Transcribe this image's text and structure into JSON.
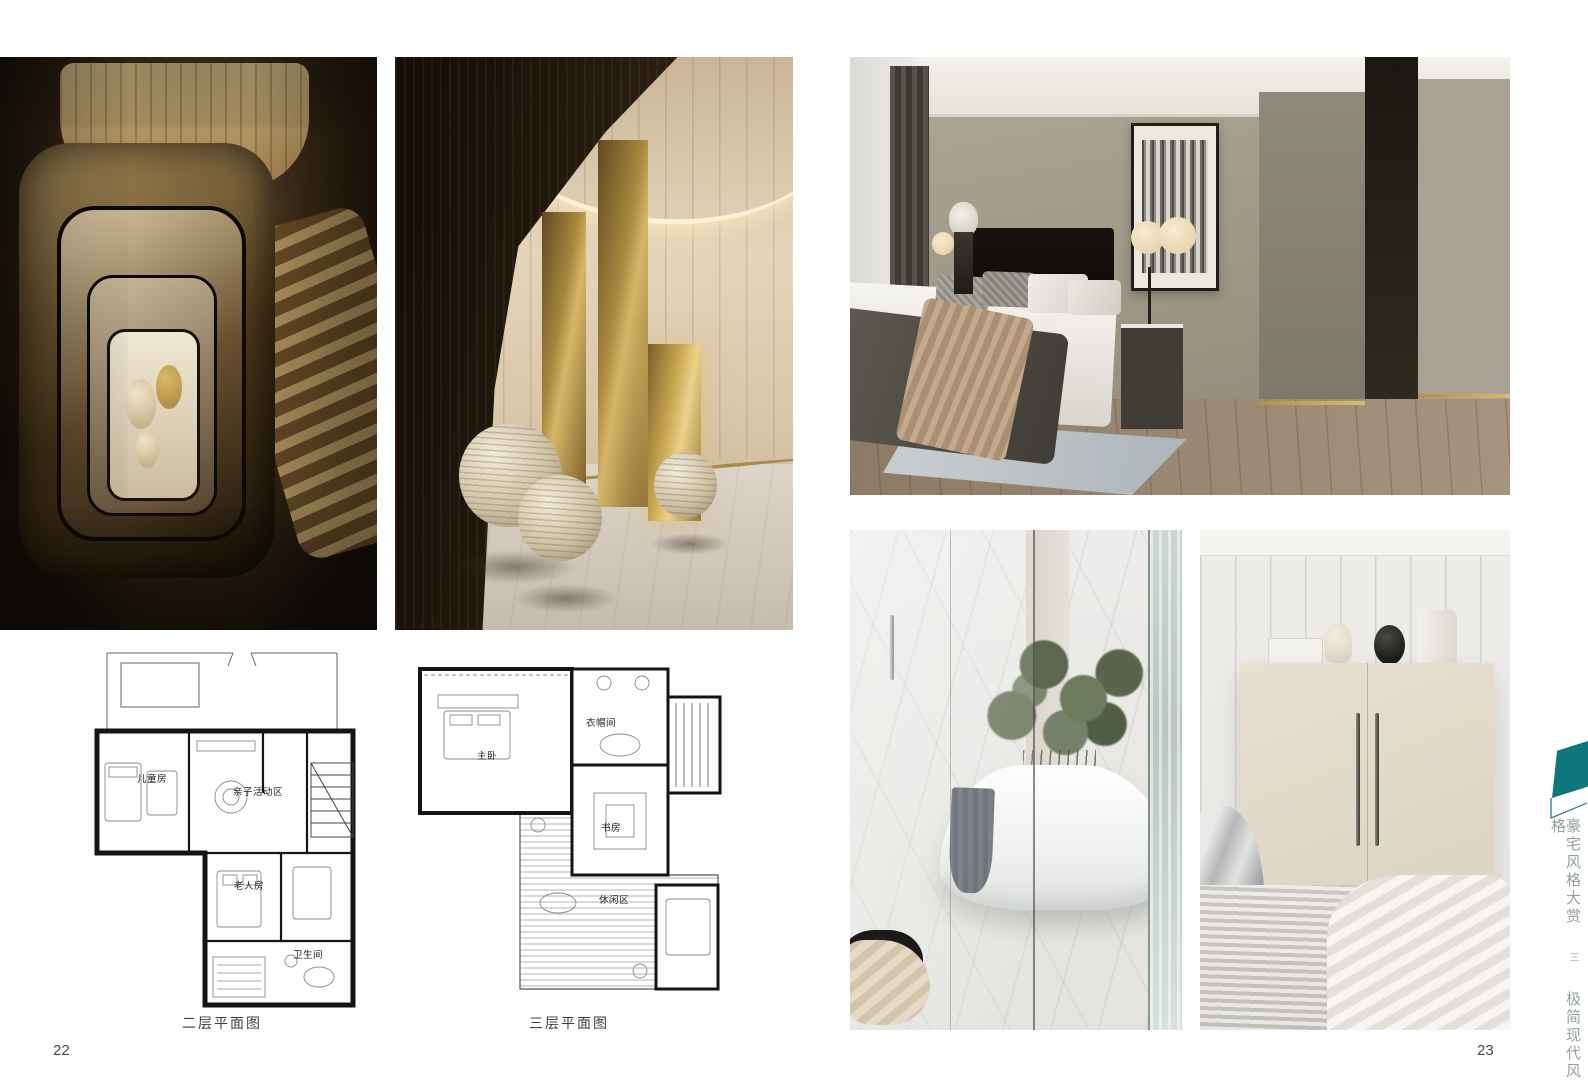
{
  "pages": {
    "left_number": "22",
    "right_number": "23"
  },
  "sidebar": {
    "series": "豪宅风格大赏",
    "divider": "三",
    "chapter": "极简现代风格",
    "accent_color": "#0f767c",
    "text_color": "#94a19e"
  },
  "floorplans": {
    "second": {
      "caption": "二层平面图",
      "rooms": {
        "kids": "儿童房",
        "activity": "亲子活动区",
        "elder": "老人房",
        "bath": "卫生间"
      }
    },
    "third": {
      "caption": "三层平面图",
      "rooms": {
        "master": "主卧",
        "cloak": "衣帽间",
        "study": "书房",
        "leisure": "休闲区"
      }
    }
  },
  "photos": {
    "stairwell": "spiral-stairwell-top-view",
    "brass": "staircase-brass-columns-spheres",
    "bedroom": "master-bedroom-grey-walls",
    "bathroom": "marble-bathroom-freestanding-tub",
    "wardrobe": "cream-wardrobe-bedroom"
  },
  "palette": {
    "accent_teal": "#0f767c",
    "brass": "#b08f4a",
    "dark_bronze": "#241709",
    "caption_gray": "#3f3f3f"
  }
}
